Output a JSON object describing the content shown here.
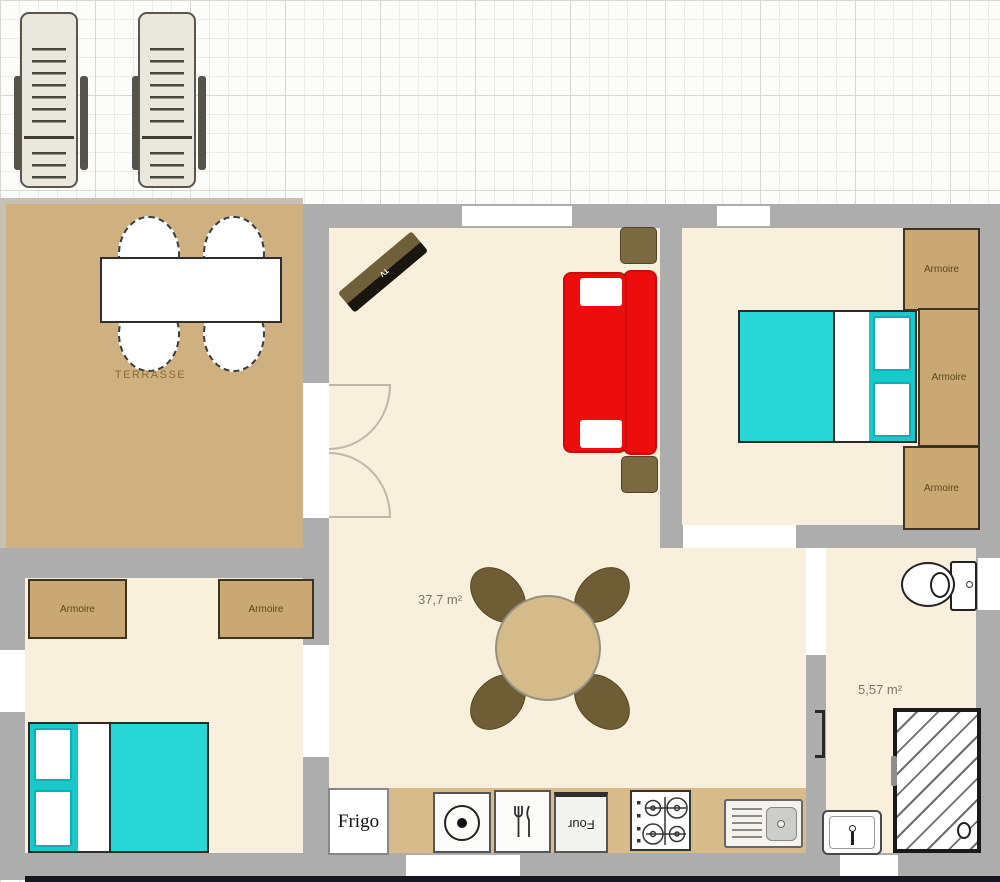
{
  "plan_labels": {
    "terrace": "TERRASSE",
    "living_area": "37,7 m²",
    "bathroom_area": "5,57 m²"
  },
  "appliances": {
    "fridge": "Frigo",
    "oven": "Four"
  },
  "tv_label": "TV",
  "wardrobes": [
    {
      "room": "bedroom-1",
      "label": "Armoire"
    },
    {
      "room": "bedroom-1",
      "label": "Armoire"
    },
    {
      "room": "bedroom-1",
      "label": "Armoire"
    },
    {
      "room": "bedroom-2",
      "label": "Armoire"
    },
    {
      "room": "bedroom-2",
      "label": "Armoire"
    }
  ],
  "colors": {
    "wall": "#adadad",
    "floor": "#f8f0dc",
    "terrace": "#cfb080",
    "counter": "#d7bb8a",
    "wardrobe": "#c9a873",
    "wardrobe-text": "#5c481c",
    "bed": "#29d6d6",
    "bed-frame": "#19c9c9",
    "sofa": "#ee0d0d",
    "chair": "#6f5e35",
    "table": "#d5ba8a",
    "area-text": "#7c7567",
    "terrace-text": "#8a6a35"
  }
}
